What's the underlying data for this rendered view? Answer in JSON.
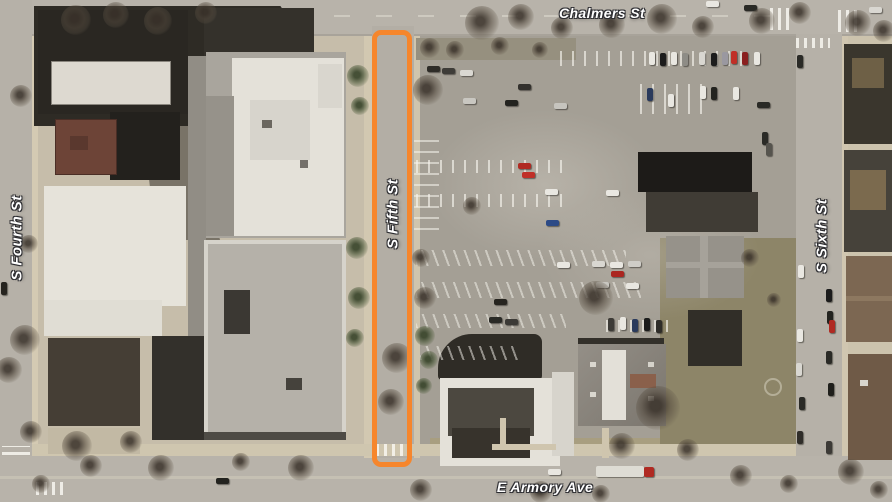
{
  "map": {
    "type": "aerial-satellite-imagery",
    "streets": {
      "top": "Chalmers St",
      "left": "S Fourth St",
      "center": "S Fifth St",
      "right": "S Sixth St",
      "bottom": "E Armory Ave"
    },
    "highlight": {
      "street": "S Fifth St",
      "color": "#F6862C",
      "shape": "rounded rectangle outline",
      "extent": "S Fifth St between Chalmers St and E Armory Ave"
    },
    "label_style": {
      "text_color": "#FFFFFF",
      "outline_color": "#2A2A2E"
    }
  }
}
